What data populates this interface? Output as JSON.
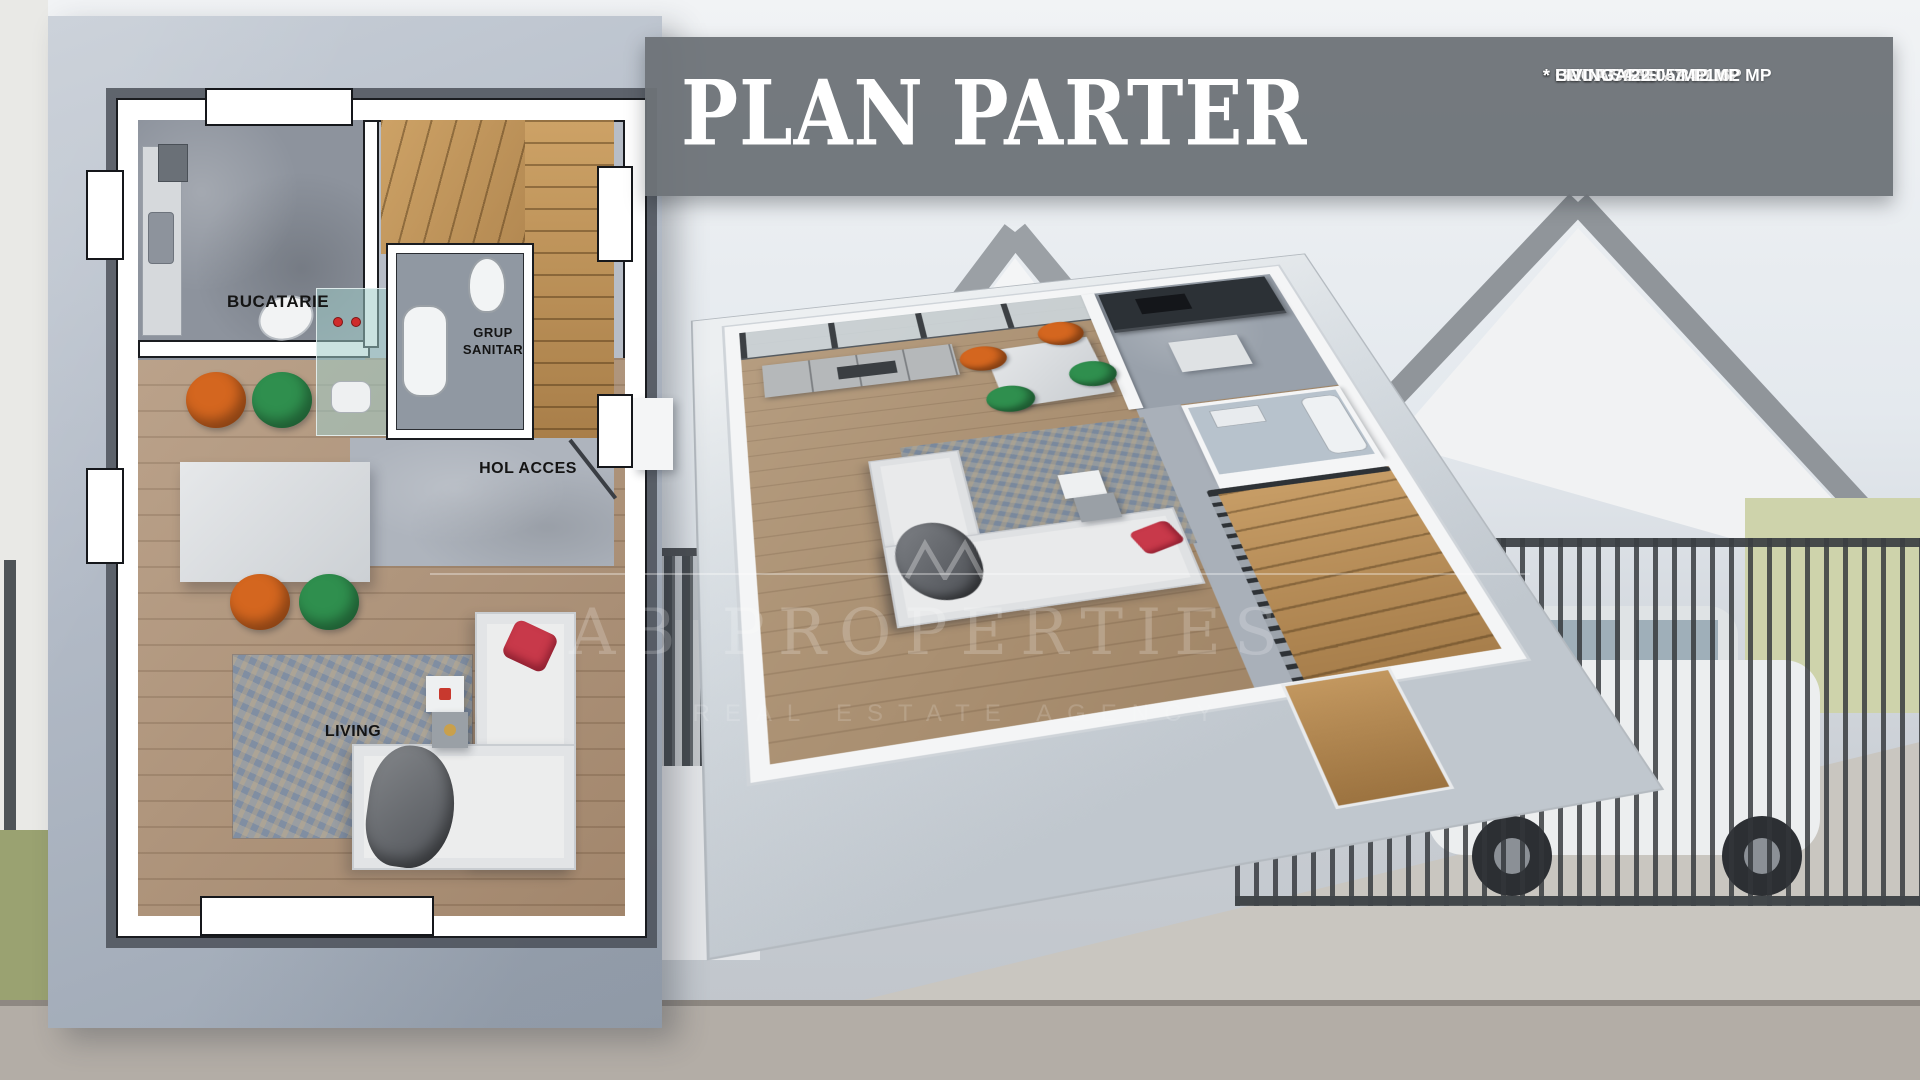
{
  "banner": {
    "title": "PLAN PARTER",
    "areas": [
      "* HOL ACCES - 2.99 MP",
      "* GRUP SANITAR - 1.62 MP",
      "* BUCATARIE - 7.42 MP",
      "* LIVING - 22.05 MP"
    ]
  },
  "plan2d": {
    "kitchen_label": "BUCATARIE",
    "bathroom_label": "GRUP SANITAR",
    "hall_label": "HOL ACCES",
    "living_label": "LIVING"
  },
  "watermark": {
    "brand": "AB PROPERTIES",
    "tagline": "REAL ESTATE AGENCY"
  },
  "colors": {
    "banner_bg": "#6d7277",
    "title_text": "#ffffff",
    "chair_orange": "#d4661f",
    "chair_green": "#2f8f4e",
    "pillow_red": "#c8394a",
    "stairs_wood": "#c49a62",
    "rug_blue": "#8b99ad"
  }
}
